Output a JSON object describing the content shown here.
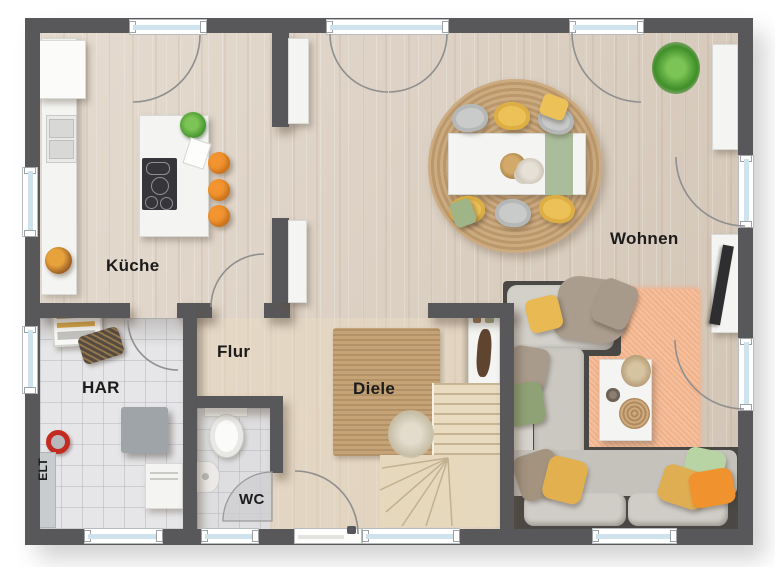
{
  "plan": {
    "title": "Erdgeschoss Grundriss",
    "rooms": {
      "kueche": {
        "label": "Küche"
      },
      "wohnen": {
        "label": "Wohnen"
      },
      "flur": {
        "label": "Flur"
      },
      "har": {
        "label": "HAR"
      },
      "diele": {
        "label": "Diele"
      },
      "wc": {
        "label": "WC"
      },
      "elt": {
        "label": "ELT"
      }
    },
    "colors": {
      "wall": "#58585a",
      "wood_floor": "#dccfc0",
      "tile_floor": "#e6e6e8",
      "window_glass": "#cfe3ef",
      "stool_orange": "#f2942f",
      "chair_yellow": "#ecc158",
      "accent_green": "#9fb487",
      "rug_jute": "#c6a377",
      "rug_peach": "#f1b28a",
      "sofa_gray": "#c8c5bf"
    }
  }
}
